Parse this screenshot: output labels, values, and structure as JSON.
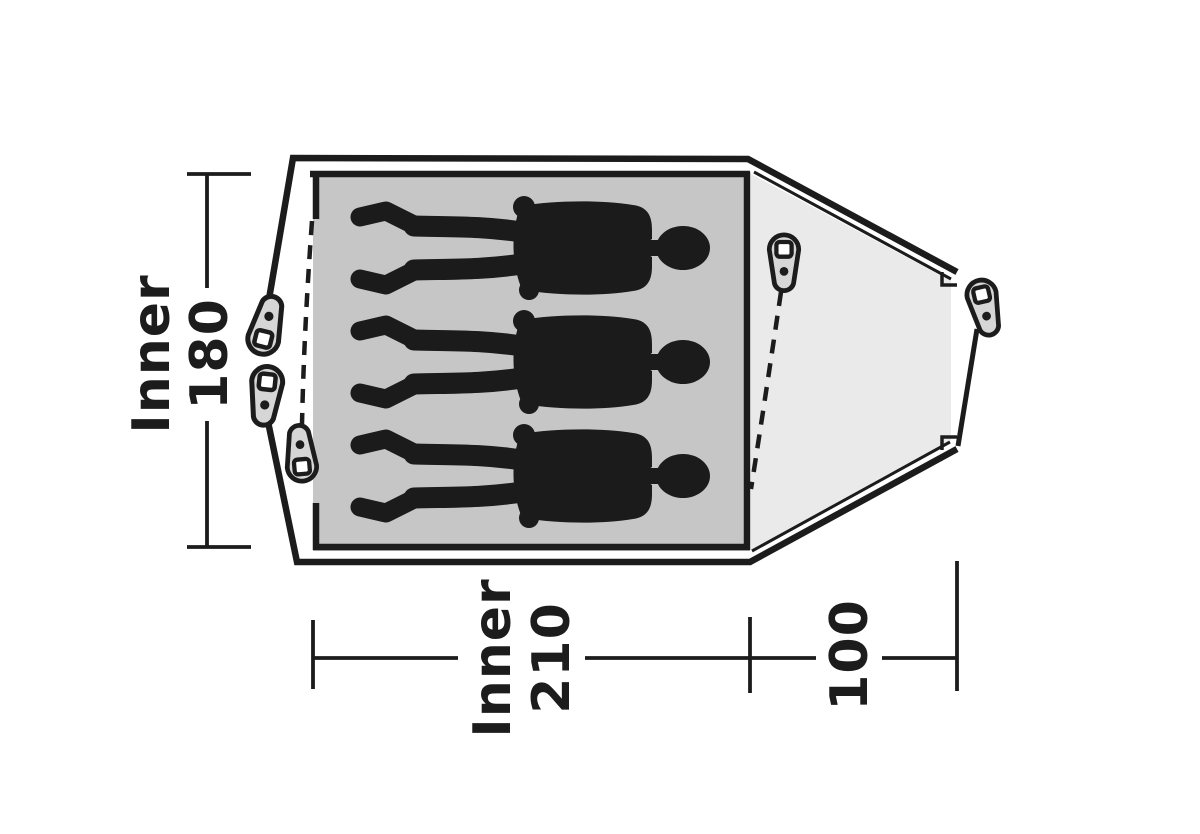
{
  "floorplan": {
    "dimensions": [
      {
        "label": "Inner",
        "value": "180"
      },
      {
        "label": "Inner",
        "value": "210"
      },
      {
        "label": "",
        "value": "100"
      }
    ],
    "occupants": 3,
    "peg_count": 5,
    "colors": {
      "line": "#1c1c1c",
      "inner_floor": "#c6c6c6",
      "porch": "#eaeaea",
      "peg": "#d6d6d6",
      "figure": "#1b1b1b",
      "background": "#ffffff"
    }
  }
}
